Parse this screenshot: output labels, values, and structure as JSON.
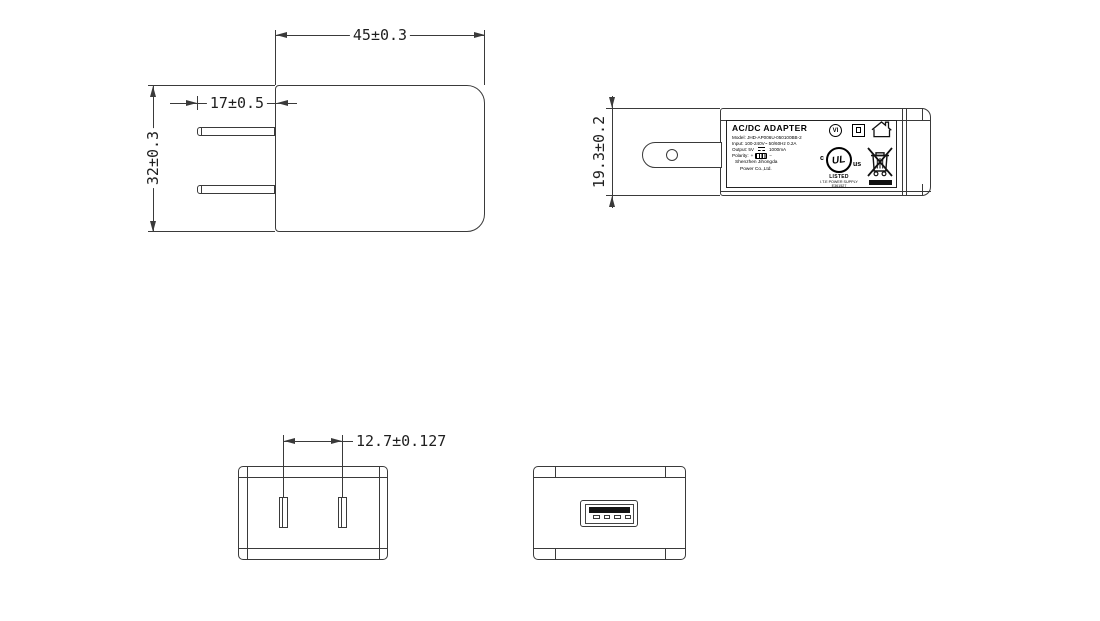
{
  "dimensions": {
    "front_width": "45±0.3",
    "front_height": "32±0.3",
    "prong_length": "17±0.5",
    "side_height": "19.3±0.2",
    "pin_spacing": "12.7±0.127"
  },
  "label": {
    "title": "AC/DC  ADAPTER",
    "model": "Model: JHD-AP006U-050100BB-2",
    "input": "Input: 100-240V~ 50/60Hz 0.2A",
    "output_pre": "Output: 5V",
    "output_post": "1000mA",
    "polarity_label": "Polarity:",
    "polarity_plus": "+",
    "polarity_minus": "−",
    "company_line1": "Shenzhen Jihongda",
    "company_line2": "Power Co.,Ltd.",
    "efficiency_mark": "VI",
    "ul_c": "c",
    "ul_center": "UL",
    "ul_us": "us",
    "ul_listed": "LISTED",
    "ul_type": "I.T.E POWER SUPPLY",
    "ul_file": "E361527"
  },
  "colors": {
    "line": "#3a3a3a",
    "text": "#1f1f1f",
    "fill_dark": "#111111",
    "background": "#ffffff"
  }
}
